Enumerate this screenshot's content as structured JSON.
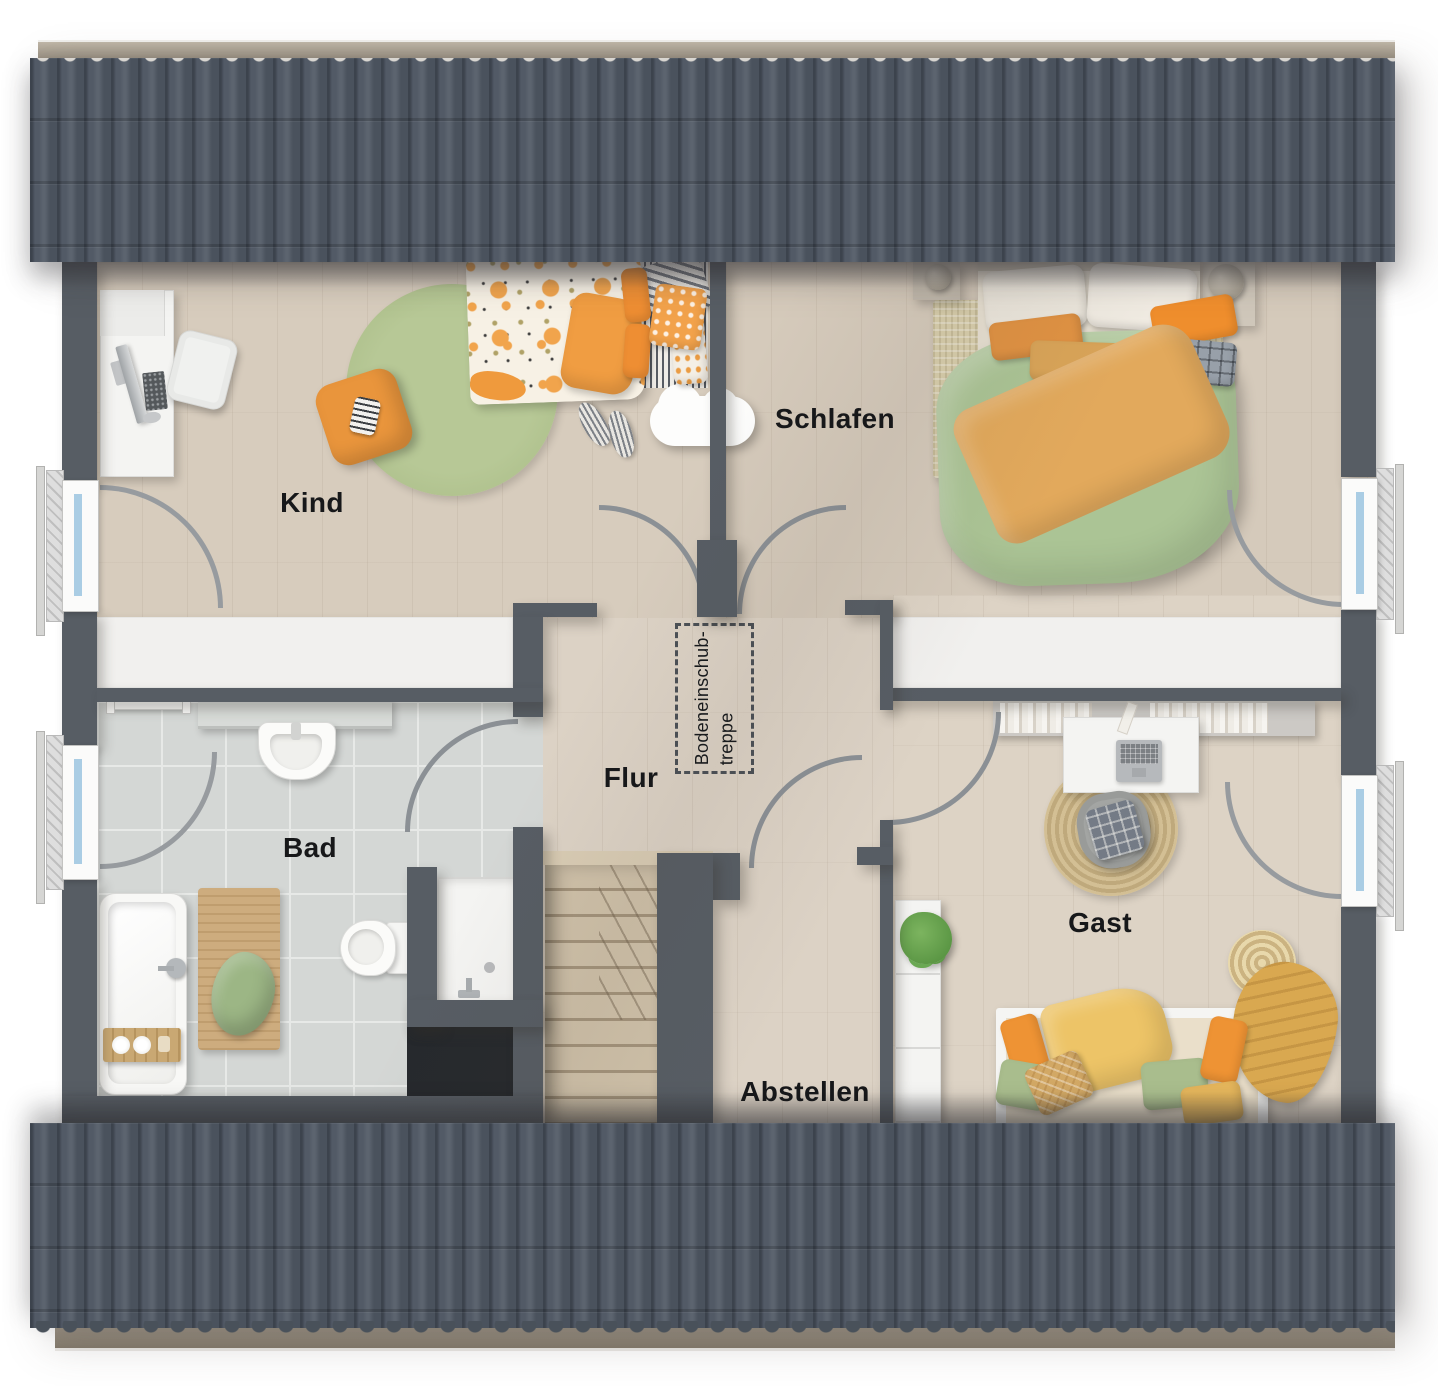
{
  "rooms": {
    "kind": {
      "label": "Kind"
    },
    "schlafen": {
      "label": "Schlafen"
    },
    "bad": {
      "label": "Bad"
    },
    "flur": {
      "label": "Flur"
    },
    "gast": {
      "label": "Gast"
    },
    "abstellen": {
      "label": "Abstellen"
    }
  },
  "annotations": {
    "attic_hatch": {
      "line1": "Bodeneinschub-",
      "line2": "treppe"
    }
  },
  "colors": {
    "roof": "#4d5561",
    "wall": "#575d64",
    "wood": "#dcd2c5",
    "tile": "#d4d7d5",
    "white": "#f1f0ee",
    "glass": "#aacde4",
    "orange": "#ee9334",
    "green": "#abc495",
    "jute": "#cdb88d"
  }
}
